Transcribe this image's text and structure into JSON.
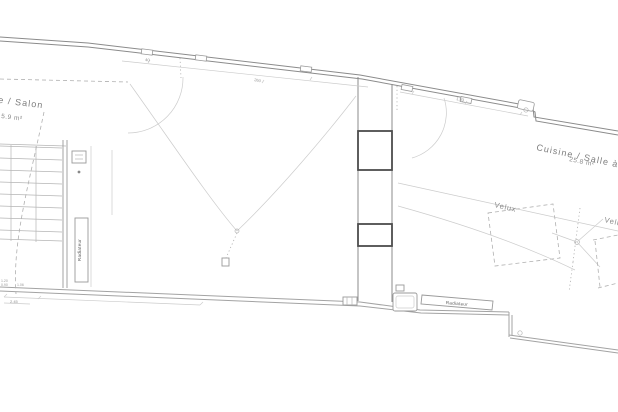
{
  "plan": {
    "rooms": {
      "salon": {
        "label": "e / Salon",
        "area": "5.9 m²"
      },
      "cuisine": {
        "label": "Cuisine / Salle à ma",
        "area": "25.8 m²"
      }
    },
    "fixtures": {
      "velux_1": "Velux",
      "velux_2": "Velux",
      "radiator_bottom": "Radiateur",
      "radiator_left": "Radiateur"
    },
    "dimensions": {
      "d40": "40",
      "d260": "260",
      "d193": "1.93",
      "d245": "2.45",
      "d120": "1.20",
      "d090": "0.90",
      "d106": "1.06"
    }
  }
}
